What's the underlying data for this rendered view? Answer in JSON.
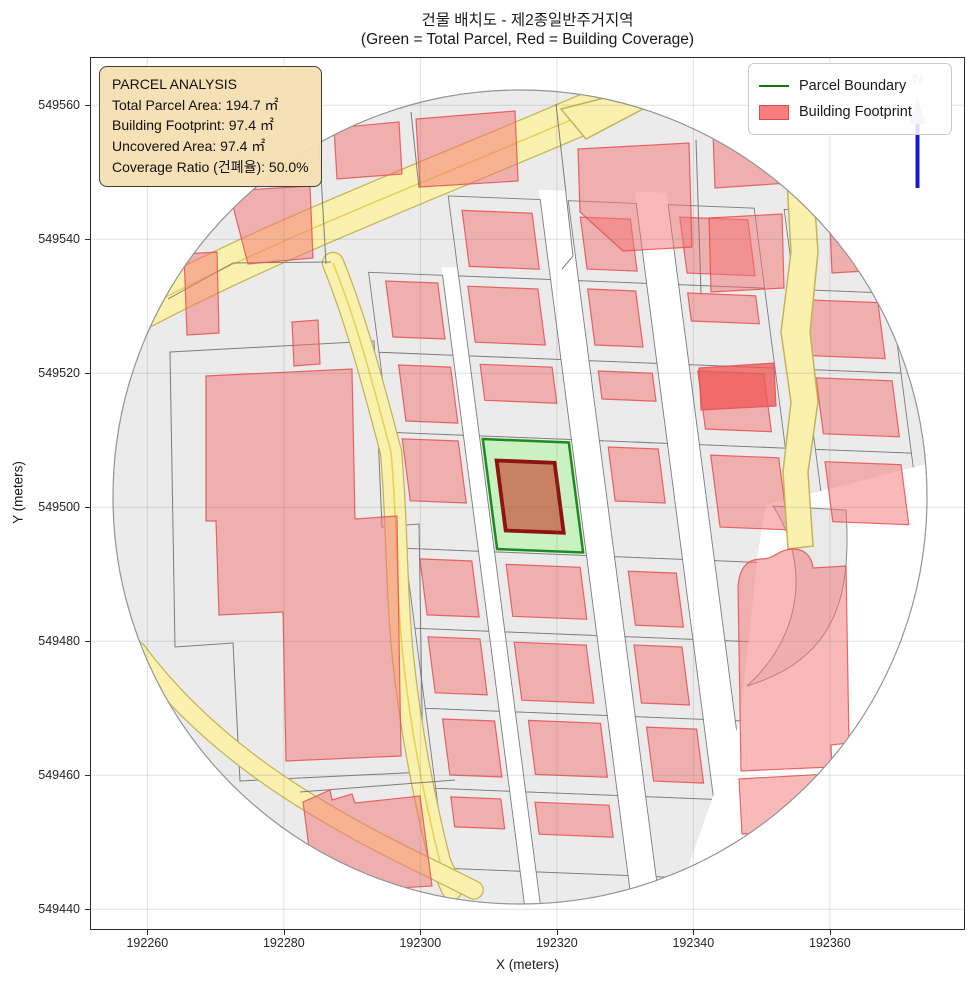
{
  "chart_data": {
    "type": "map",
    "title": "건물 배치도 - 제2종일반주거지역",
    "subtitle": "(Green = Total Parcel, Red = Building Coverage)",
    "xlabel": "X (meters)",
    "ylabel": "Y (meters)",
    "x_ticks": [
      192260,
      192280,
      192300,
      192320,
      192340,
      192360
    ],
    "y_ticks": [
      549440,
      549460,
      549480,
      549500,
      549520,
      549540,
      549560
    ],
    "x_range": [
      192251.6,
      192379.8
    ],
    "y_range": [
      549436.9,
      549567.2
    ],
    "grid": true,
    "legend_position": "upper right",
    "legend": [
      {
        "label": "Parcel Boundary",
        "type": "line",
        "color": "#0f7a0f"
      },
      {
        "label": "Building Footprint",
        "type": "patch",
        "color": "#f97f7f",
        "edge": "#e04b4b"
      }
    ],
    "annotation": {
      "lines": [
        "PARCEL ANALYSIS",
        "Total Parcel Area: 194.7 ㎡",
        "Building Footprint: 97.4 ㎡",
        "Uncovered Area: 97.4 ㎡",
        "Coverage Ratio (건폐율): 50.0%"
      ]
    },
    "parcel_analysis": {
      "total_parcel_area_m2": 194.7,
      "building_footprint_m2": 97.4,
      "uncovered_area_m2": 97.4,
      "coverage_ratio_pct": 50.0
    },
    "north_label": "N"
  },
  "map": {
    "colors": {
      "parcel_fill": "#ebebeb",
      "parcel_stroke": "#7c7c7c",
      "building_fill": "rgba(244,115,115,0.5)",
      "building_stroke": "rgba(229,80,80,0.85)",
      "building_dark_fill": "rgba(240,90,90,0.78)",
      "road_fill": "#faf1ae",
      "road_edge": "#c5b455",
      "road_center": "#e8d052",
      "green_fill": "#c9f1c2",
      "green_stroke": "#1e8b1e",
      "center_building_fill": "rgba(198,62,40,0.62)",
      "center_building_stroke": "#8e1310",
      "white": "#ffffff",
      "circle_stroke": "#949494",
      "gridline": "rgba(120,120,120,0.22)",
      "north_line": "#1a1acd",
      "north_light": "#b9b9ec"
    },
    "circle": {
      "cx": 520,
      "cy": 497,
      "r": 407
    },
    "shear": {
      "kx": 0.13,
      "ky": 0.04,
      "ax": 350,
      "ay": 520
    },
    "grid": {
      "cols": {
        "A": [
          378,
          452
        ],
        "B": [
          468,
          560
        ],
        "C": [
          588,
          656
        ],
        "D": [
          688,
          774
        ],
        "E": [
          804,
          900
        ]
      },
      "rows": {
        "r1": [
          198,
          278
        ],
        "r2": [
          278,
          358
        ],
        "r3": [
          358,
          438
        ],
        "r4": [
          438,
          554
        ],
        "r5": [
          554,
          634
        ],
        "r6": [
          634,
          714
        ],
        "r7": [
          714,
          794
        ],
        "r8": [
          794,
          874
        ],
        "r9": [
          874,
          912
        ]
      },
      "streets": [
        {
          "x": [
            452,
            468
          ],
          "y": [
            270,
            912
          ]
        },
        {
          "x": [
            560,
            588
          ],
          "y": [
            188,
            912
          ]
        },
        {
          "x": [
            656,
            688
          ],
          "y": [
            186,
            912
          ]
        }
      ],
      "buildings": [
        {
          "c": "A",
          "r": "r2",
          "m": [
            8,
            6,
            16,
            16
          ]
        },
        {
          "c": "A",
          "r": "r3",
          "m": [
            12,
            4,
            12,
            18
          ]
        },
        {
          "c": "A",
          "r": "r4",
          "m": [
            6,
            6,
            48,
            12
          ]
        },
        {
          "c": "A",
          "r": "r5",
          "m": [
            10,
            8,
            14,
            14
          ]
        },
        {
          "c": "A",
          "r": "r6",
          "m": [
            8,
            10,
            16,
            12
          ]
        },
        {
          "c": "A",
          "r": "r7",
          "m": [
            10,
            6,
            14,
            16
          ]
        },
        {
          "c": "A",
          "r": "r8",
          "m": [
            8,
            10,
            42,
            14
          ]
        },
        {
          "c": "B",
          "r": "r1",
          "m": [
            14,
            10,
            10,
            12
          ]
        },
        {
          "c": "B",
          "r": "r2",
          "m": [
            10,
            14,
            14,
            8
          ]
        },
        {
          "c": "B",
          "r": "r3",
          "m": [
            8,
            10,
            36,
            10
          ]
        },
        {
          "c": "B",
          "r": "r5",
          "m": [
            12,
            8,
            16,
            10
          ]
        },
        {
          "c": "B",
          "r": "r6",
          "m": [
            10,
            12,
            12,
            8
          ]
        },
        {
          "c": "B",
          "r": "r7",
          "m": [
            8,
            8,
            18,
            12
          ]
        },
        {
          "c": "B",
          "r": "r8",
          "m": [
            10,
            10,
            38,
            8
          ]
        },
        {
          "c": "C",
          "r": "r1",
          "m": [
            16,
            8,
            12,
            10
          ]
        },
        {
          "c": "C",
          "r": "r2",
          "m": [
            8,
            12,
            16,
            8
          ]
        },
        {
          "c": "C",
          "r": "r3",
          "m": [
            10,
            6,
            42,
            8
          ]
        },
        {
          "c": "C",
          "r": "r4",
          "m": [
            6,
            10,
            56,
            8
          ]
        },
        {
          "c": "C",
          "r": "r5",
          "m": [
            14,
            8,
            12,
            12
          ]
        },
        {
          "c": "C",
          "r": "r6",
          "m": [
            8,
            12,
            14,
            8
          ]
        },
        {
          "c": "C",
          "r": "r7",
          "m": [
            10,
            8,
            16,
            10
          ]
        },
        {
          "c": "D",
          "r": "r1",
          "m": [
            12,
            8,
            12,
            10
          ]
        },
        {
          "c": "D",
          "r": "r2",
          "m": [
            8,
            10,
            44,
            8
          ]
        },
        {
          "c": "D",
          "r": "r3",
          "m": [
            6,
            12,
            16,
            8
          ]
        },
        {
          "c": "D",
          "r": "r4",
          "m": [
            10,
            8,
            34,
            10
          ]
        },
        {
          "c": "E",
          "r": "r2",
          "m": [
            10,
            14,
            14,
            8
          ]
        },
        {
          "c": "E",
          "r": "r3",
          "m": [
            8,
            10,
            16,
            10
          ]
        },
        {
          "c": "E",
          "r": "r4",
          "m": [
            12,
            12,
            44,
            8
          ]
        }
      ],
      "green_cell": {
        "c": "B",
        "r": "r4",
        "inset": 3
      },
      "center_building": [
        482,
        462,
        540,
        532
      ]
    },
    "white_region": "M766,505 L950,458 L950,915 L622,915 L680,890 L740,720 L758,552 Z",
    "crescent": "M773,506 L846,510 C852,600 834,659 747,686 C806,632 808,560 773,506 Z",
    "left_outline": "M170,352 L374,341 L382,527 L419,524 L423,772 L240,781 L233,643 L175,647 Z",
    "parcel_lines": [
      "M318,122 L326,264",
      "M411,112 L419,188",
      "M168,299 L233,263 L331,262",
      "M556,104 L573,256 L562,269",
      "M696,140 L701,293",
      "M788,120 L801,181",
      "M300,792 L455,780"
    ],
    "roads": [
      {
        "d": "M100,332 C260,242 440,178 624,97",
        "w": 38,
        "center": true
      },
      {
        "d": "M333,263 C356,320 372,380 391,452 C397,515 396,590 403,658 C410,724 422,790 440,862 L452,889",
        "w": 20,
        "center": true
      },
      {
        "d": "M137,651 C205,742 300,806 432,869 L474,890",
        "w": 17,
        "center": false
      }
    ],
    "road_polys": [
      {
        "points": "787,181 813,179 818,252 810,332 818,402 808,472 813,546 788,549 783,472 791,402 781,332 791,252"
      },
      {
        "points": "561,109 628,92 643,109 586,139"
      }
    ],
    "manual_buildings": [
      {
        "points": "334,128 399,122 402,174 337,179"
      },
      {
        "points": "416,119 515,111 518,181 420,187"
      },
      {
        "points": "578,149 689,143 692,247 623,251 580,212"
      },
      {
        "points": "713,133 771,129 789,183 715,188"
      },
      {
        "points": "709,218 782,214 784,288 711,292"
      },
      {
        "points": "830,227 867,224 865,271 832,273"
      },
      {
        "points": "229,191 310,186 313,258 248,264"
      },
      {
        "points": "184,254 217,252 219,333 187,335"
      },
      {
        "points": "292,322 318,320 320,364 294,366"
      },
      {
        "points": "206,376 352,369 355,519 397,516 401,756 286,761 283,612 219,615 216,521 206,521"
      },
      {
        "points": "303,802 330,790 332,800 352,794 355,803 420,796 432,886 315,893"
      },
      {
        "d": "M738,586 C740,566 748,559 762,559 C774,559 779,549 793,549 C805,549 812,557 813,568 L846,566 L849,743 L831,745 L832,767 L741,771 Z"
      },
      {
        "d": "M739,779 L846,773 C841,801 812,823 772,833 L742,834 Z"
      }
    ],
    "dark_building": {
      "points": "699,368 774,363 776,406 701,410"
    },
    "north_arrow": {
      "x": 917.5,
      "line_y1": 122,
      "line_y2": 188,
      "head": "917.5,98 909.5,124 925.5,124",
      "label_y": 84
    }
  }
}
